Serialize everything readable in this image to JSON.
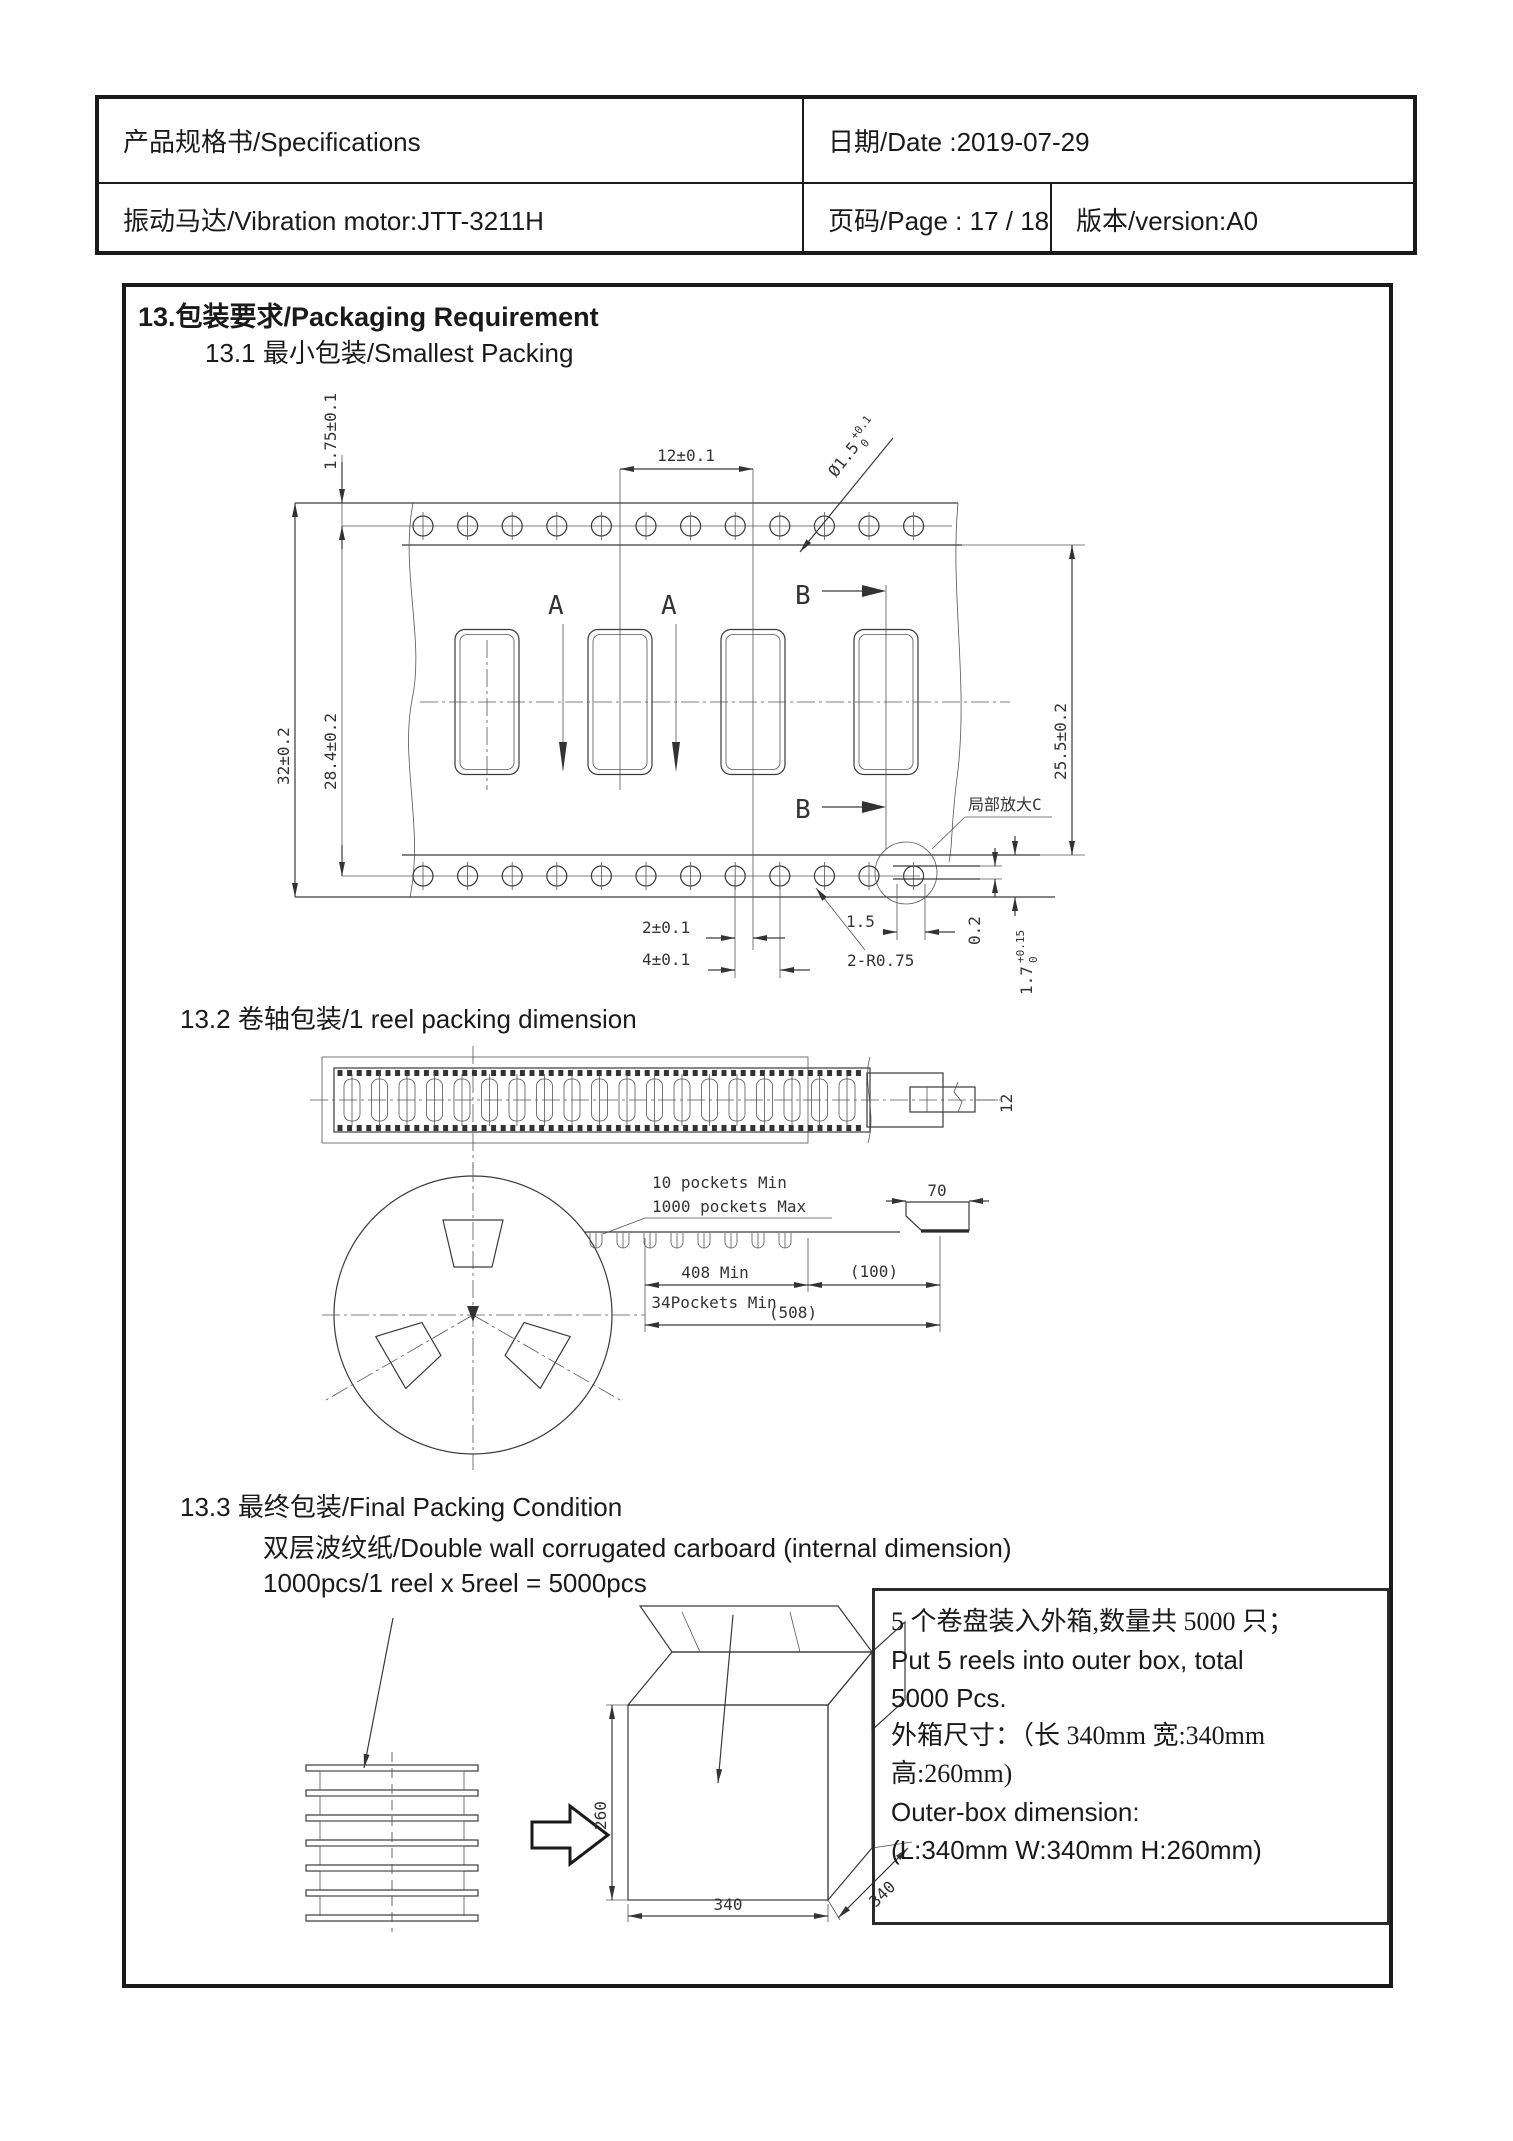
{
  "header": {
    "row1": {
      "left": "产品规格书/Specifications",
      "right": "日期/Date :2019-07-29"
    },
    "row2": {
      "left": "振动马达/Vibration motor:JTT-3211H",
      "mid": "页码/Page :  17 / 18",
      "right": "版本/version:A0"
    }
  },
  "content": {
    "s13": "13.包装要求/Packaging Requirement",
    "s13_1": "13.1 最小包装/Smallest Packing",
    "s13_2": "13.2 卷轴包装/1 reel packing dimension",
    "s13_3": "13.3 最终包装/Final Packing Condition",
    "s13_3_sub1": "双层波纹纸/Double wall corrugated carboard (internal dimension)",
    "s13_3_sub2": "1000pcs/1 reel x 5reel = 5000pcs"
  },
  "drawing1": {
    "dim_175": "1.75±0.1",
    "dim_pitch": "12±0.1",
    "hole_main": "Ø1.5",
    "hole_tol_up": "+0.1",
    "hole_tol_dn": "0",
    "dim_32": "32±0.2",
    "dim_284": "28.4±0.2",
    "dim_255": "25.5±0.2",
    "label_a": "A",
    "label_b": "B",
    "detail_label": "局部放大C",
    "dim_2": "2±0.1",
    "dim_4": "4±0.1",
    "dim_15": "1.5",
    "dim_radius": "2-R0.75",
    "dim_02": "0.2",
    "dim_17": "1.7",
    "dim_17_tol_up": "+0.15",
    "dim_17_tol_dn": "0"
  },
  "drawing2": {
    "note1": "10 pockets Min",
    "note2": "1000 pockets Max",
    "dim_12": "12",
    "dim_70": "70",
    "dim_408": "408 Min",
    "dim_100": "(100)",
    "dim_34": "34Pockets Min",
    "dim_508": "(508)"
  },
  "drawing3": {
    "dim_260": "260",
    "dim_340w": "340",
    "dim_340d": "340"
  },
  "note_box": {
    "lines": [
      "5 个卷盘装入外箱,数量共 5000 只；",
      "Put 5 reels into outer box, total",
      "5000 Pcs.",
      "外箱尺寸：（长 340mm 宽:340mm",
      "高:260mm)",
      "Outer-box dimension:",
      "(L:340mm W:340mm H:260mm)"
    ]
  }
}
